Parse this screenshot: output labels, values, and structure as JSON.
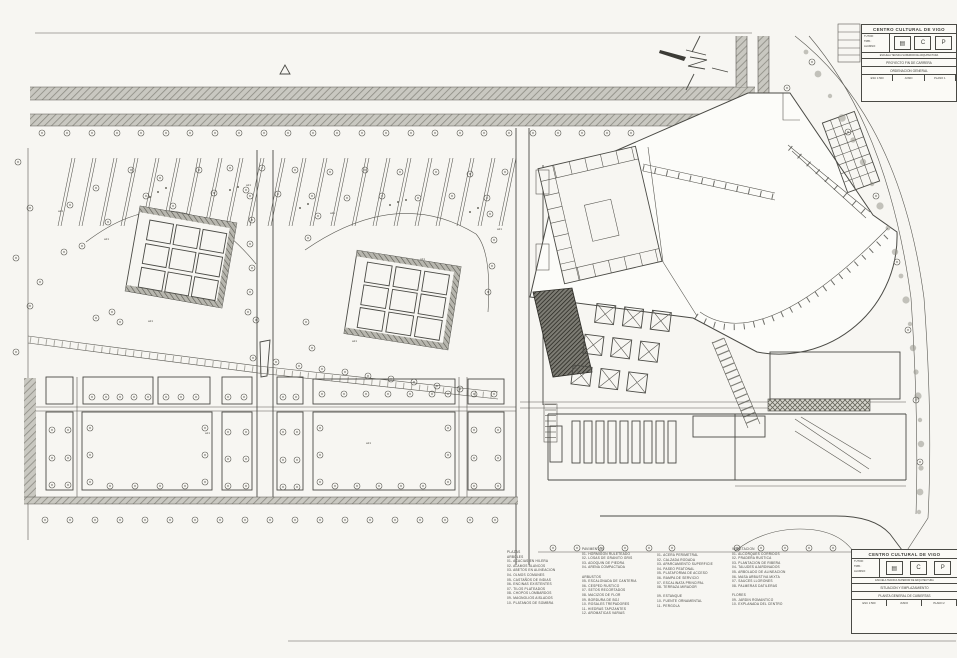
{
  "sheet": {
    "background": "#f7f6f2",
    "ink": "#4a4a45",
    "road_fill": "#c9c8c1",
    "dark_hatch_fill": "#3d3c38"
  },
  "plan_labels": {
    "tree_tag": "a21"
  },
  "legend": {
    "columns": [
      {
        "lines": [
          "PLAZAS",
          "ARBOLES",
          "01- ACACIAS EN HILERA",
          "02- ALAMOS BLANCOS",
          "03- ABETOS EN ALINEACION",
          "04- OLMOS COMUNES",
          "05- CASTAÑOS DE INDIAS",
          "06- ENCINAS EXISTENTES",
          "07- TILOS PLATEADOS",
          "08- CHOPOS LOMBARDOS",
          "09- MAGNOLIOS AISLADOS",
          "10- PLATANOS DE SOMBRA"
        ]
      },
      {
        "lines": [
          "PAVIMENTOS",
          "01- HORMIGON RULETEADO",
          "02- LOSAS DE GRANITO GRIS",
          "03- ADOQUIN DE PIEDRA",
          "04- ARENA COMPACTADA",
          "",
          "ARBUSTOS",
          "05- ESCALONADA DE CANTERIA",
          "06- CESPED RUSTICO",
          "07- SETOS RECORTADOS",
          "08- MACIZOS DE FLOR",
          "09- BORDURA DE BOJ",
          "10- ROSALES TREPADORES",
          "11- HIEDRAS TAPIZANTES",
          "12- AROMATICAS VARIAS"
        ]
      },
      {
        "lines": [
          "01- ACERA PERIMETRAL",
          "02- CALZADA RODADA",
          "03- APARCAMIENTO SUPERFICIE",
          "04- PASEO PEATONAL",
          "05- PLATAFORMA DE ACCESO",
          "06- RAMPA DE SERVICIO",
          "07- ESCALINATA PRINCIPAL",
          "08- TERRAZA MIRADOR",
          "",
          "09- ESTANQUE",
          "10- FUENTE ORNAMENTAL",
          "11- PERGOLA"
        ]
      },
      {
        "lines": [
          "VEGETACION",
          "01- ALCORQUES CORRIDOS",
          "02- PRADERA RUSTICA",
          "03- PLANTACION DE RIBERA",
          "04- TALUDES AJARDINADOS",
          "05- ARBOLADO DE ALINEACION",
          "06- MASA ARBUSTIVA MIXTA",
          "07- SAUCES LLORONES",
          "08- PALMERAS DATILERAS",
          "",
          "FLORES",
          "09- JARDIN ROMANTICO",
          "10- EXPLANADA DEL CENTRO"
        ]
      }
    ]
  },
  "title_block_top": {
    "title": "CENTRO CULTURAL DE VIGO",
    "side_labels": [
      "TUTOR:",
      "TRIB.:",
      "ALUMNO:"
    ],
    "stamps": [
      "▤",
      "C",
      "P"
    ],
    "note": "ESCUELA TECNICA SUPERIOR DE ARQUITECTURA",
    "rows": [
      "PROYECTO FIN DE CARRERA",
      "ORDENACION GENERAL"
    ],
    "footer": [
      "ESC 1:500",
      "JUNIO",
      "PLANO 1"
    ]
  },
  "title_block_bottom": {
    "title": "CENTRO CULTURAL DE VIGO",
    "side_labels": [
      "TUTOR:",
      "TRIB.:",
      "ALUMNO:"
    ],
    "stamps": [
      "▤",
      "C",
      "P"
    ],
    "note": "ESCUELA TECNICA SUPERIOR DE ARQUITECTURA",
    "rows": [
      "SITUACION Y EMPLAZAMIENTO",
      "PLANTA GENERAL DE CUBIERTAS"
    ],
    "footer": [
      "ESC 1:500",
      "JUNIO",
      "PLANO 2"
    ]
  }
}
